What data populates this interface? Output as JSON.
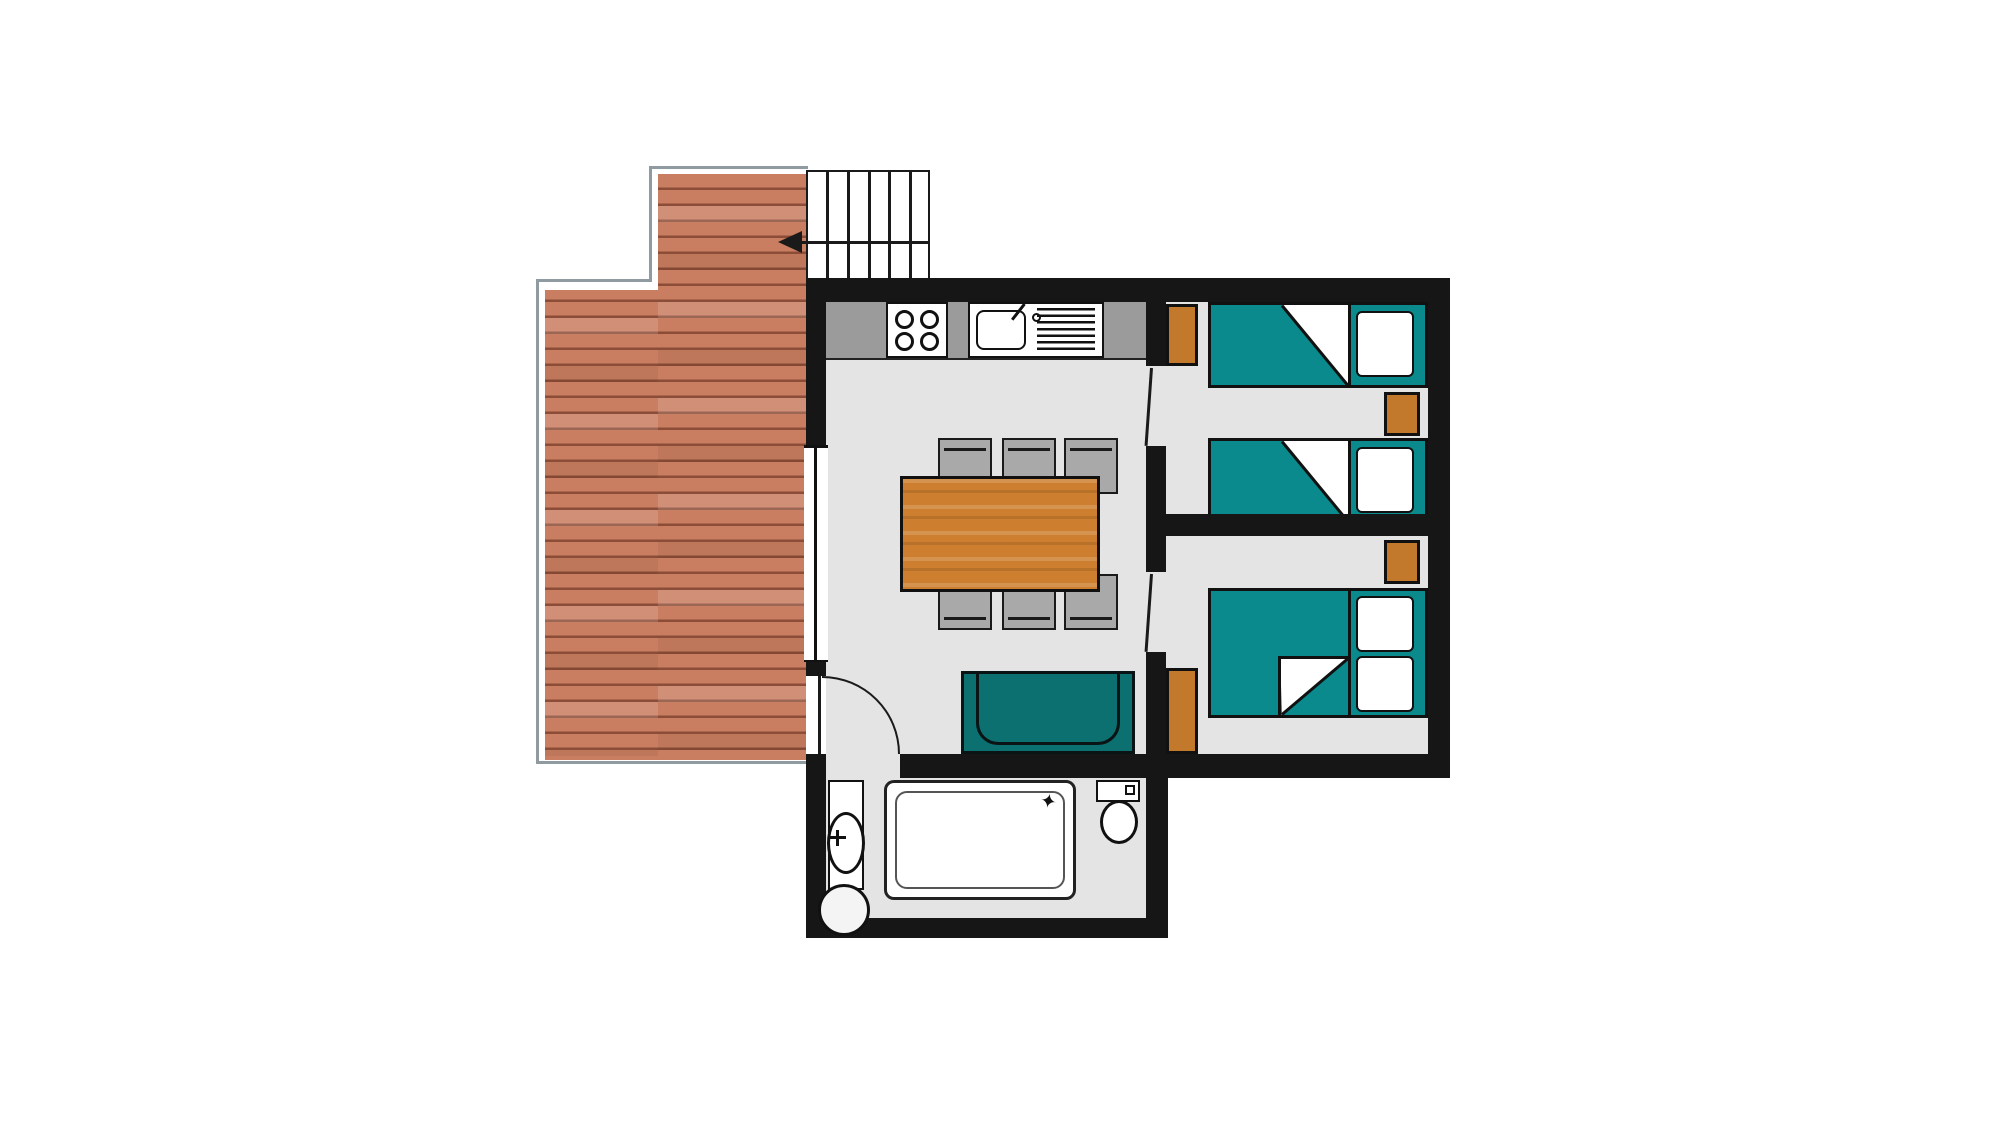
{
  "document": {
    "type": "floor-plan"
  },
  "palette": {
    "wall": "#161616",
    "floor": "#e4e4e4",
    "counter": "#9b9b9b",
    "bed": "#0a8a8c",
    "sofa": "#0c6f70",
    "wood": "#c3792b",
    "table": "#cd7e2e",
    "chair": "#a9a9a9",
    "plank": "#c97d61",
    "plankline": "#8b4d37",
    "outline": "#8f9ba0",
    "line": "#1a1a1a"
  },
  "features": {
    "stair_treads": 6,
    "stove_burners": 4,
    "dining_chairs": 6,
    "single_beds": 2,
    "double_beds": 1,
    "wardrobes": 2,
    "nightstands": 2,
    "sofas": 1,
    "showers": 1,
    "toilets": 1,
    "washbasins": 1,
    "dining_tables": 1
  },
  "icons": {
    "shower_sparkle": {
      "glyph": "✦"
    }
  }
}
